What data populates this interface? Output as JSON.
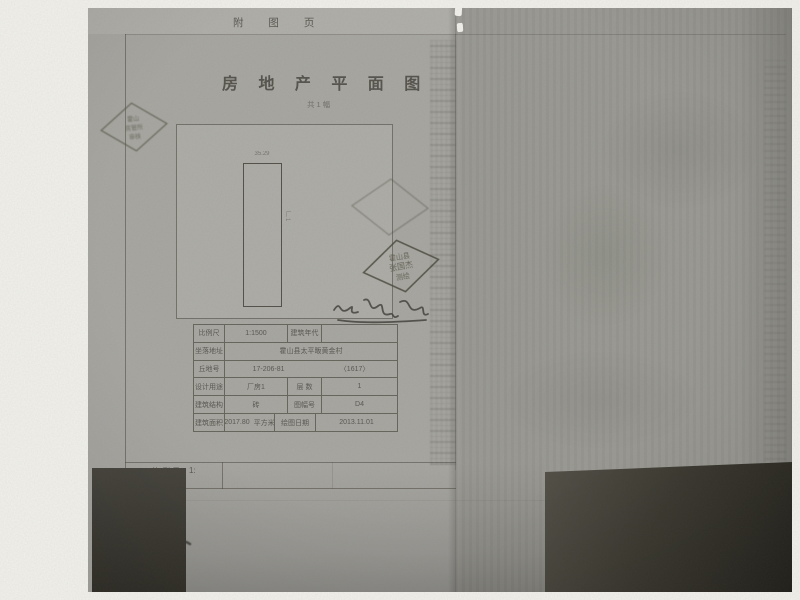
{
  "header": {
    "page_label": "附 图 页"
  },
  "title": {
    "text": "房 地 产 平 面 图",
    "subtitle": "共1幅"
  },
  "plan": {
    "dim_top": "35.29",
    "building_label": "厂1"
  },
  "stamps": {
    "left": {
      "line1": "霍山",
      "line2": "房管所",
      "line3": "审核"
    },
    "right": {
      "line1": "霍山县",
      "line2": "张国杰",
      "line3": "测绘"
    }
  },
  "table": {
    "rows": [
      {
        "c0": "比例尺",
        "c1": "1:1500",
        "c2": "建筑年代",
        "c3": ""
      },
      {
        "c0": "坐落地址",
        "c1": "霍山县太平畈黄金村"
      },
      {
        "c0": "丘地号",
        "c1": "17-206-81",
        "c2": "〈1617〉"
      },
      {
        "c0": "设计用途",
        "c1": "厂房1",
        "c2": "层  数",
        "c3": "1"
      },
      {
        "c0": "建筑结构",
        "c1": "砖",
        "c2": "图幅号",
        "c3": "D4"
      },
      {
        "c0": "建筑面积",
        "c1": "2017.80",
        "c1u": "平方米",
        "c2": "绘图日期",
        "c3": "2013.11.01"
      }
    ]
  },
  "footer": {
    "scale_label": "比例尺",
    "scale_value": "1:"
  },
  "colors": {
    "paper": "#a8a7a2",
    "paper_right": "#9b9a94",
    "ink": "#4f4d45",
    "shadow": "#2f2d26",
    "mat": "#f2f1ec"
  }
}
